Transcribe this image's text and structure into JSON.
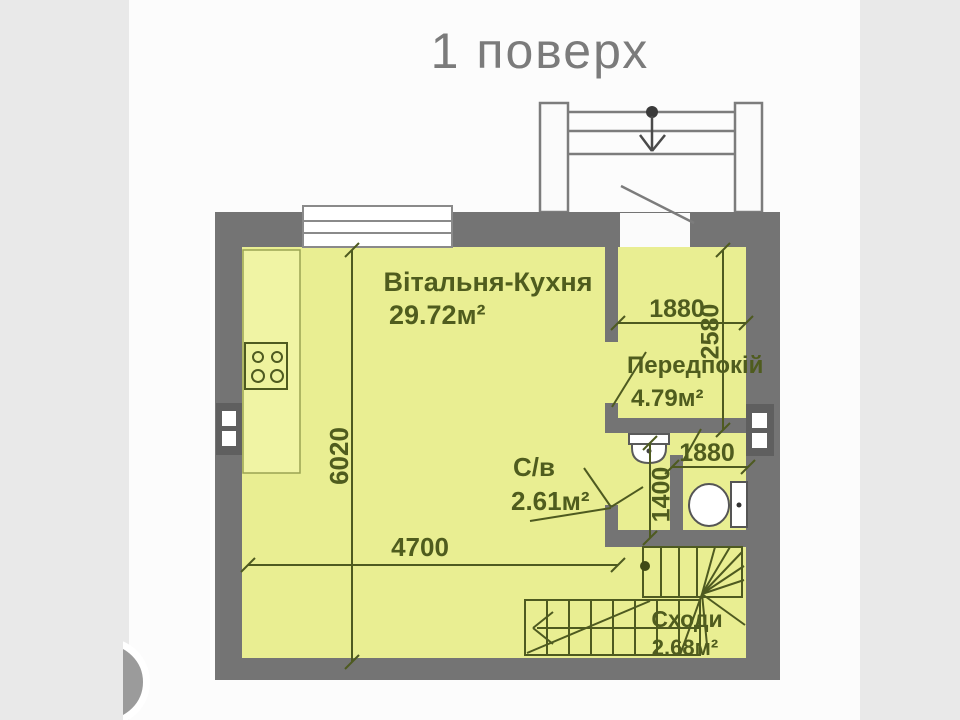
{
  "title": "1 поверх",
  "colors": {
    "page_bg": "#e9e9e9",
    "content_bg": "#fcfcfc",
    "wall": "#747474",
    "room_fill": "#e9ee92",
    "counter_fill": "#f0f4a4",
    "line": "#4e5a20",
    "label": "#4f5c1e",
    "title": "#7b7b7b",
    "fixture": "#ffffff"
  },
  "plan": {
    "rooms": [
      {
        "name": "Вітальня-Кухня",
        "area": "29.72м²"
      },
      {
        "name": "Передпокій",
        "area": "4.79м²"
      },
      {
        "name": "С/в",
        "area": "2.61м²"
      },
      {
        "name": "Сходи",
        "area": "2.68м²"
      }
    ],
    "dimensions": {
      "living_width": "4700",
      "living_depth": "6020",
      "hallway_width": "1880",
      "hallway_depth": "2580",
      "wc_width": "1880",
      "wc_depth": "1400"
    }
  }
}
